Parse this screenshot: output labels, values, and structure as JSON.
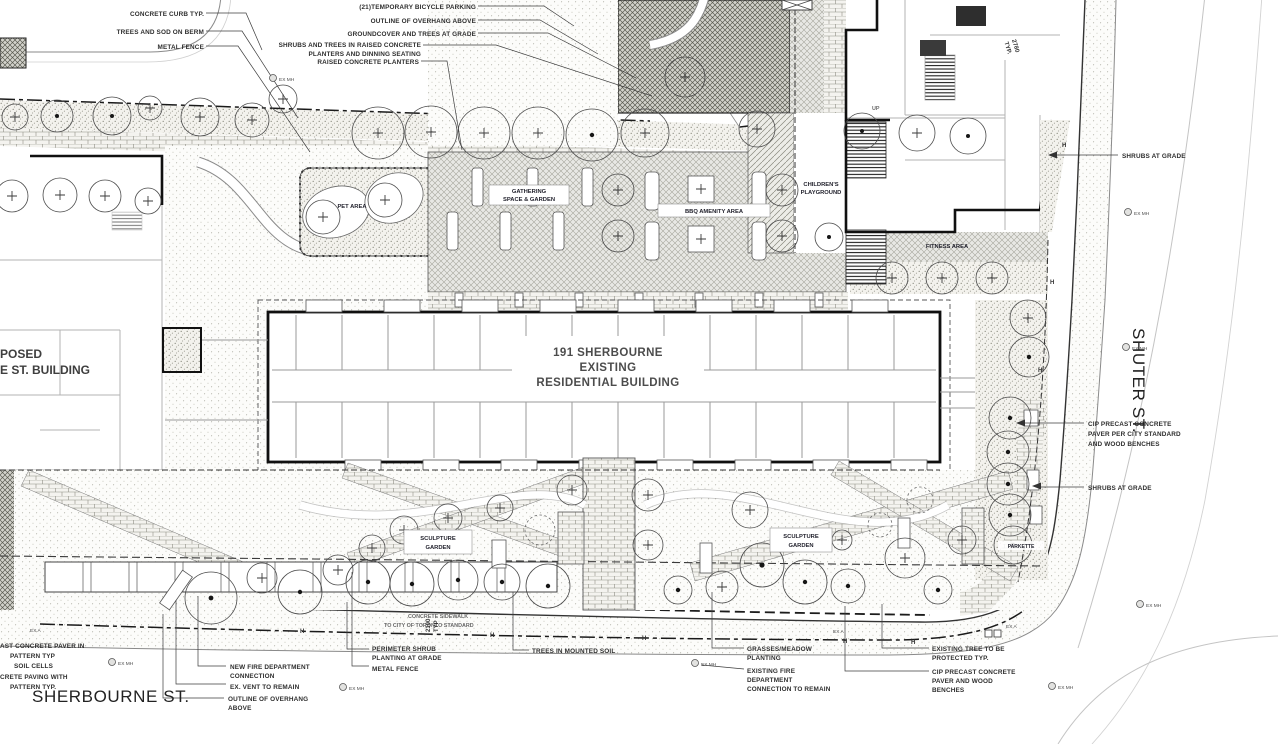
{
  "plan": {
    "building": {
      "l1": "191  SHERBOURNE",
      "l2": "EXISTING",
      "l3": "RESIDENTIAL BUILDING"
    },
    "adjacent": {
      "l1": "POSED",
      "l2": "E ST. BUILDING"
    },
    "streets": {
      "sherbourne": "SHERBOURNE ST.",
      "shuter": "SHUTER ST."
    },
    "areas": {
      "pet": "PET AREA",
      "gathering1": "GATHERING",
      "gathering2": "SPACE & GARDEN",
      "bbq": "BBQ AMENITY AREA",
      "play1": "CHILDREN'S",
      "play2": "PLAYGROUND",
      "fitness": "FITNESS AREA",
      "sculpt1": "SCULPTURE",
      "sculpt2": "GARDEN",
      "parkette": "PARKETTE"
    },
    "dims": {
      "d2780a": "2780",
      "d2780b": "TYP.",
      "d2100a": "2100",
      "d2100b": "TYP"
    },
    "markers": {
      "exmh": "EX MH",
      "exa": "EX A",
      "h": "H",
      "up": "UP"
    },
    "ann": {
      "curb": "CONCRETE CURB TYP.",
      "berm": "TREES AND SOD ON BERM",
      "fence_top": "METAL FENCE",
      "bike": "(21)TEMPORARY BICYCLE PARKING",
      "overhang_top": "OUTLINE OF OVERHANG ABOVE",
      "groundcover": "GROUNDCOVER AND TREES AT GRADE",
      "shrubs_raised1": "SHRUBS AND TREES IN RAISED CONCRETE",
      "shrubs_raised2": "PLANTERS AND DINNING SEATING",
      "raised_planters": "RAISED CONCRETE PLANTERS",
      "shrubs_grade1": "SHRUBS AT GRADE",
      "cip_r1": "CIP PRECAST CONCRETE",
      "cip_r2": "PAVER  PER CITY STANDARD",
      "cip_r3": "AND WOOD BENCHES",
      "shrubs_grade2": "SHRUBS AT GRADE",
      "paver1": "AST CONCRETE PAVER   IN",
      "paver2": "PATTERN TYP",
      "soil": "SOIL CELLS",
      "paving1": "CRETE PAVING WITH",
      "paving2": "PATTERN  TYP.",
      "newfire1": "NEW FIRE DEPARTMENT",
      "newfire2": "CONNECTION",
      "vent": "EX. VENT TO REMAIN",
      "overhang_b1": "OUTLINE OF OVERHANG",
      "overhang_b2": "ABOVE",
      "perim1": "PERIMETER SHRUB",
      "perim2": "PLANTING AT GRADE",
      "fence_b": "METAL FENCE",
      "mounted": "TREES IN MOUNTED SOIL",
      "grass1": "GRASSES/MEADOW",
      "grass2": "PLANTING",
      "exfire1": "EXISTING FIRE",
      "exfire2": "DEPARTMENT",
      "exfire3": "CONNECTION TO REMAIN",
      "extree1": "EXISTING TREE TO BE",
      "extree2": "PROTECTED TYP.",
      "cip_b1": "CIP PRECAST CONCRETE",
      "cip_b2": "PAVER  AND WOOD",
      "cip_b3": "BENCHES",
      "sidewalk1": "CONCRETE SIDEWALK",
      "sidewalk2": "TO CITY OF TORONTO STANDARD"
    }
  }
}
